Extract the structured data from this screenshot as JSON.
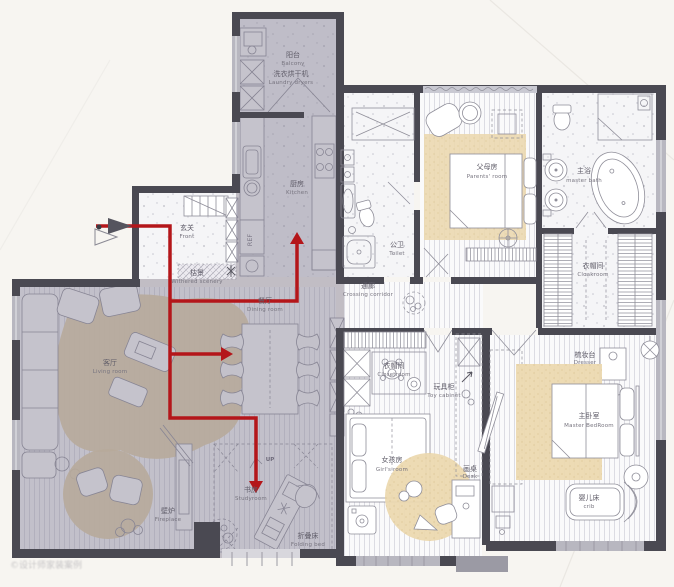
{
  "colors": {
    "overlay_zone": "#7f7a8e",
    "wall_dark": "#4a4952",
    "window_gray": "#b8b7c0",
    "accent_red": "#b4161a",
    "rug_beige": "#e6d2a6",
    "label_gray": "#5f5c68",
    "paper": "#f7f5f1"
  },
  "labels": {
    "balcony": {
      "zh": "阳台",
      "en": "Balcony"
    },
    "laundry": {
      "zh": "洗衣烘干机",
      "en": "Laundry dryers"
    },
    "kitchen": {
      "zh": "厨房",
      "en": "Kitchen"
    },
    "front": {
      "zh": "玄关",
      "en": "Front"
    },
    "withered": {
      "zh": "枯景",
      "en": "Withered scenery"
    },
    "living": {
      "zh": "客厅",
      "en": "Living room"
    },
    "dining": {
      "zh": "餐厅",
      "en": "Dining room"
    },
    "fireplace": {
      "zh": "壁炉",
      "en": "Fireplace"
    },
    "study": {
      "zh": "书房",
      "en": "Studyroom"
    },
    "folding_bed": {
      "zh": "折叠床",
      "en": "Folding bed"
    },
    "toilet": {
      "zh": "公卫",
      "en": "Toilet"
    },
    "parents": {
      "zh": "父母房",
      "en": "Parents' room"
    },
    "master_bath": {
      "zh": "主浴",
      "en": "master bath"
    },
    "cloakroom": {
      "zh": "衣帽间",
      "en": "Cloakroom"
    },
    "corridor": {
      "zh": "通廊",
      "en": "Crossing corridor"
    },
    "closetroom": {
      "zh": "衣帽间",
      "en": "Closetroom"
    },
    "toy_cabinet": {
      "zh": "玩具柜",
      "en": "Toy cabinet"
    },
    "girls_room": {
      "zh": "女孩房",
      "en": "Girl's room"
    },
    "desk": {
      "zh": "画桌",
      "en": "Desk"
    },
    "dresser": {
      "zh": "梳妆台",
      "en": "Dresser"
    },
    "master_bed": {
      "zh": "主卧室",
      "en": "Master BedRoom"
    },
    "crib": {
      "zh": "婴儿床",
      "en": "crib"
    },
    "up": {
      "en": "UP"
    },
    "ref": {
      "en": "REF"
    }
  },
  "watermark": "©设计师家装案例"
}
